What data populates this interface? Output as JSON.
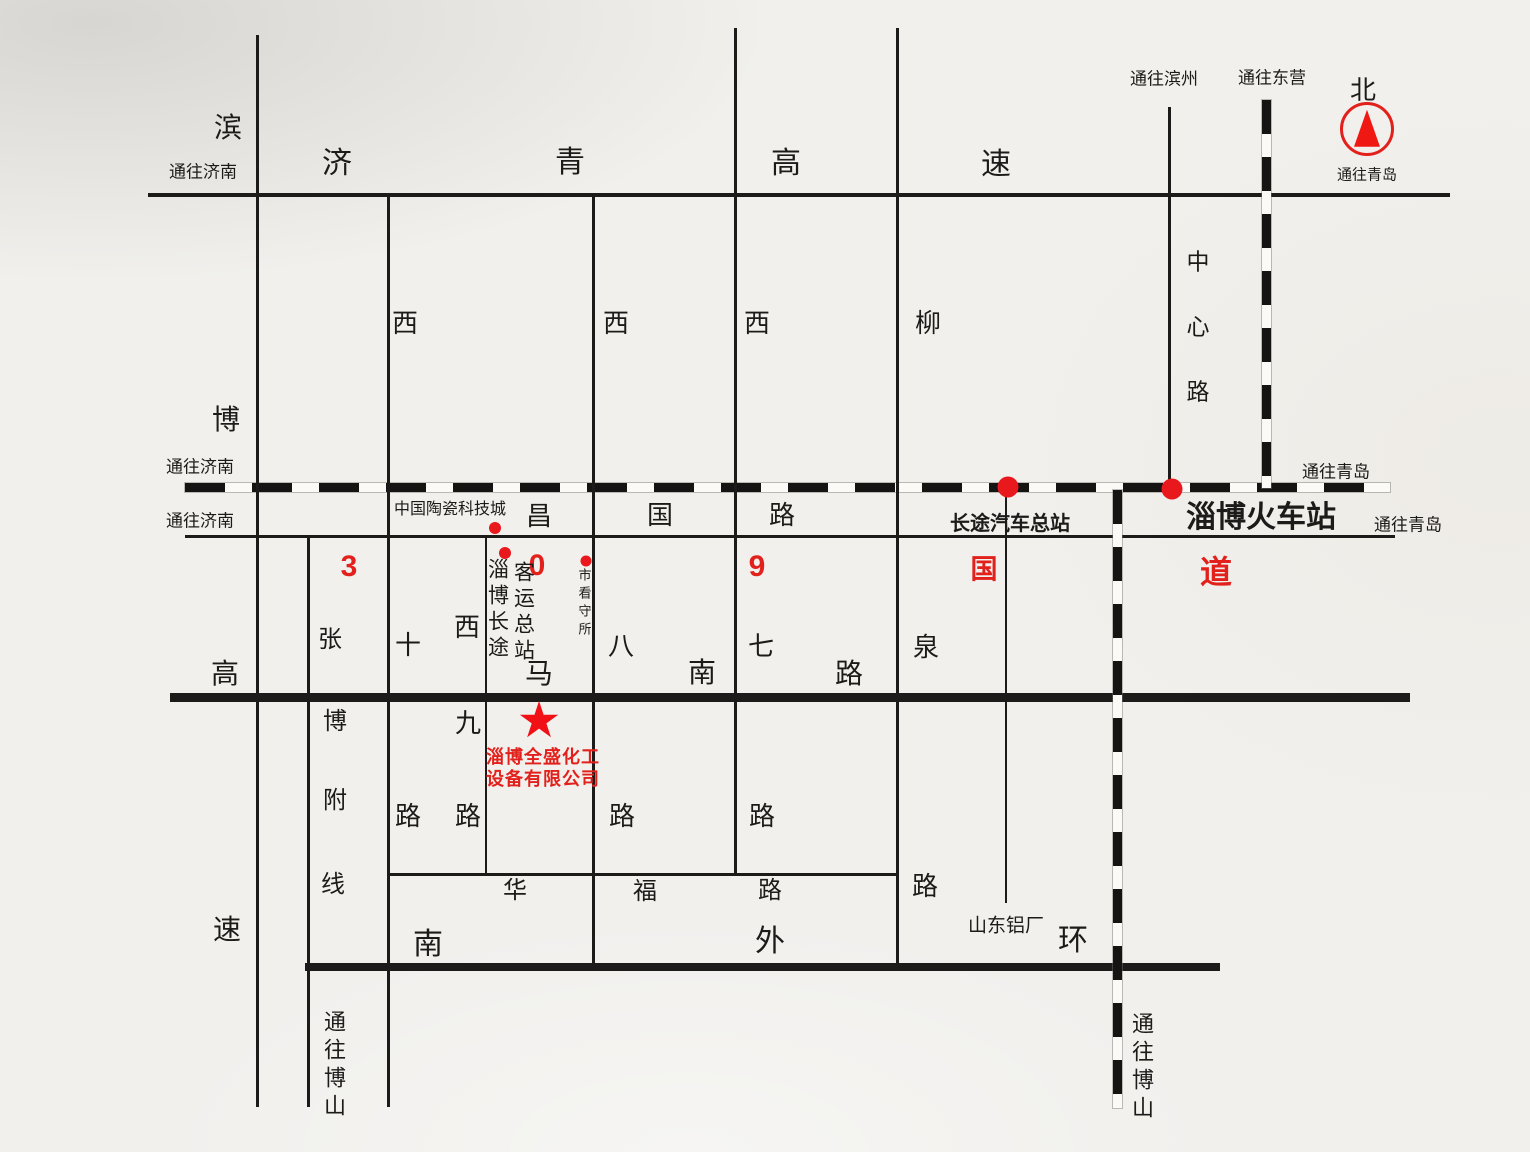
{
  "colors": {
    "accent_red": "#e2211c",
    "ink": "#1d1b19",
    "paper": "#f1f0ed"
  },
  "directions": {
    "to_jinan_top": "通往济南",
    "to_jinan_rail": "通往济南",
    "to_jinan_changguo": "通往济南",
    "to_qingdao_top": "通往青岛",
    "to_qingdao_rail": "通往青岛",
    "to_qingdao_changguo": "通往青岛",
    "to_binzhou": "通往滨州",
    "to_dongying": "通往东营",
    "to_boshan_left": "通往博山",
    "to_boshan_rail": "通往博山",
    "north": "北"
  },
  "road_names": {
    "jiqing_expressway": [
      "济",
      "青",
      "高",
      "速"
    ],
    "binbo_expressway": [
      "滨",
      "博",
      "高",
      "速"
    ],
    "zhangbo_branch": [
      "张",
      "博",
      "附",
      "线"
    ],
    "xi_shi_road": [
      "西",
      "十",
      "路"
    ],
    "xi_jiu_road": [
      "西",
      "九",
      "路"
    ],
    "xi_ba_road": [
      "西",
      "八",
      "路"
    ],
    "xi_qi_road": [
      "西",
      "七",
      "路"
    ],
    "liuquan_road": [
      "柳",
      "泉",
      "路"
    ],
    "zhongxin_road": [
      "中",
      "心",
      "路"
    ],
    "changguo_road": [
      "昌",
      "国",
      "路"
    ],
    "manan_road": [
      "马",
      "南",
      "路"
    ],
    "huafu_road": [
      "华",
      "福",
      "路"
    ],
    "nan_waihuan_road": [
      "南",
      "外",
      "环"
    ]
  },
  "route_309": [
    "3",
    "0",
    "9",
    "国",
    "道"
  ],
  "landmarks": {
    "ceramic_city": "中国陶瓷科技城",
    "bus_terminal_col1": "淄博长途",
    "bus_terminal_col2": "客运总站",
    "detention_house": "市看守所",
    "bus_station": "长途汽车总站",
    "railway_station": "淄博火车站",
    "aluminum_plant": "山东铝厂"
  },
  "company": {
    "name_line1": "淄博全盛化工",
    "name_line2": "设备有限公司"
  },
  "icons": {
    "star": "★",
    "north_compass": "red circle with up arrow"
  }
}
